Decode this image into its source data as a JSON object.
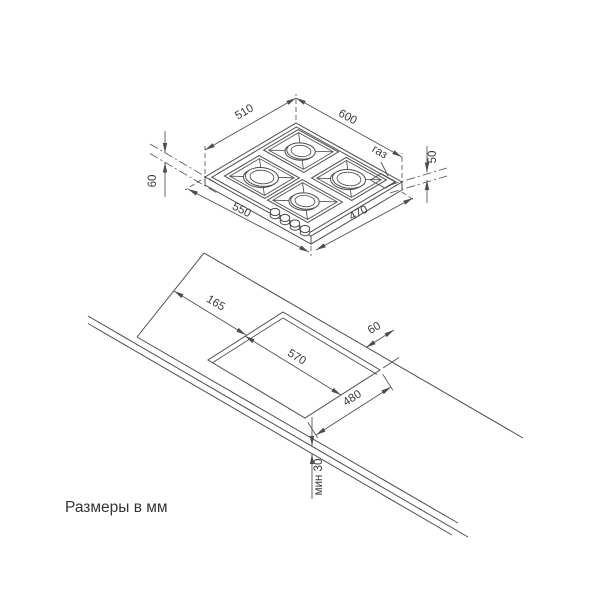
{
  "caption": "Размеры в мм",
  "hob_view": {
    "dim_top_left": "510",
    "dim_top_right": "600",
    "dim_bottom_left": "550",
    "dim_bottom_right": "470",
    "dim_height_left": "60",
    "dim_height_right": "50",
    "gas_label": "газ"
  },
  "cutout_view": {
    "dim_inset_left": "165",
    "dim_cutout_width": "570",
    "dim_cutout_depth": "480",
    "dim_back_gap": "60",
    "dim_front_min": "мин 30"
  },
  "colors": {
    "line": "#4d4d4d",
    "text": "#3a3a3a",
    "background": "#ffffff"
  }
}
